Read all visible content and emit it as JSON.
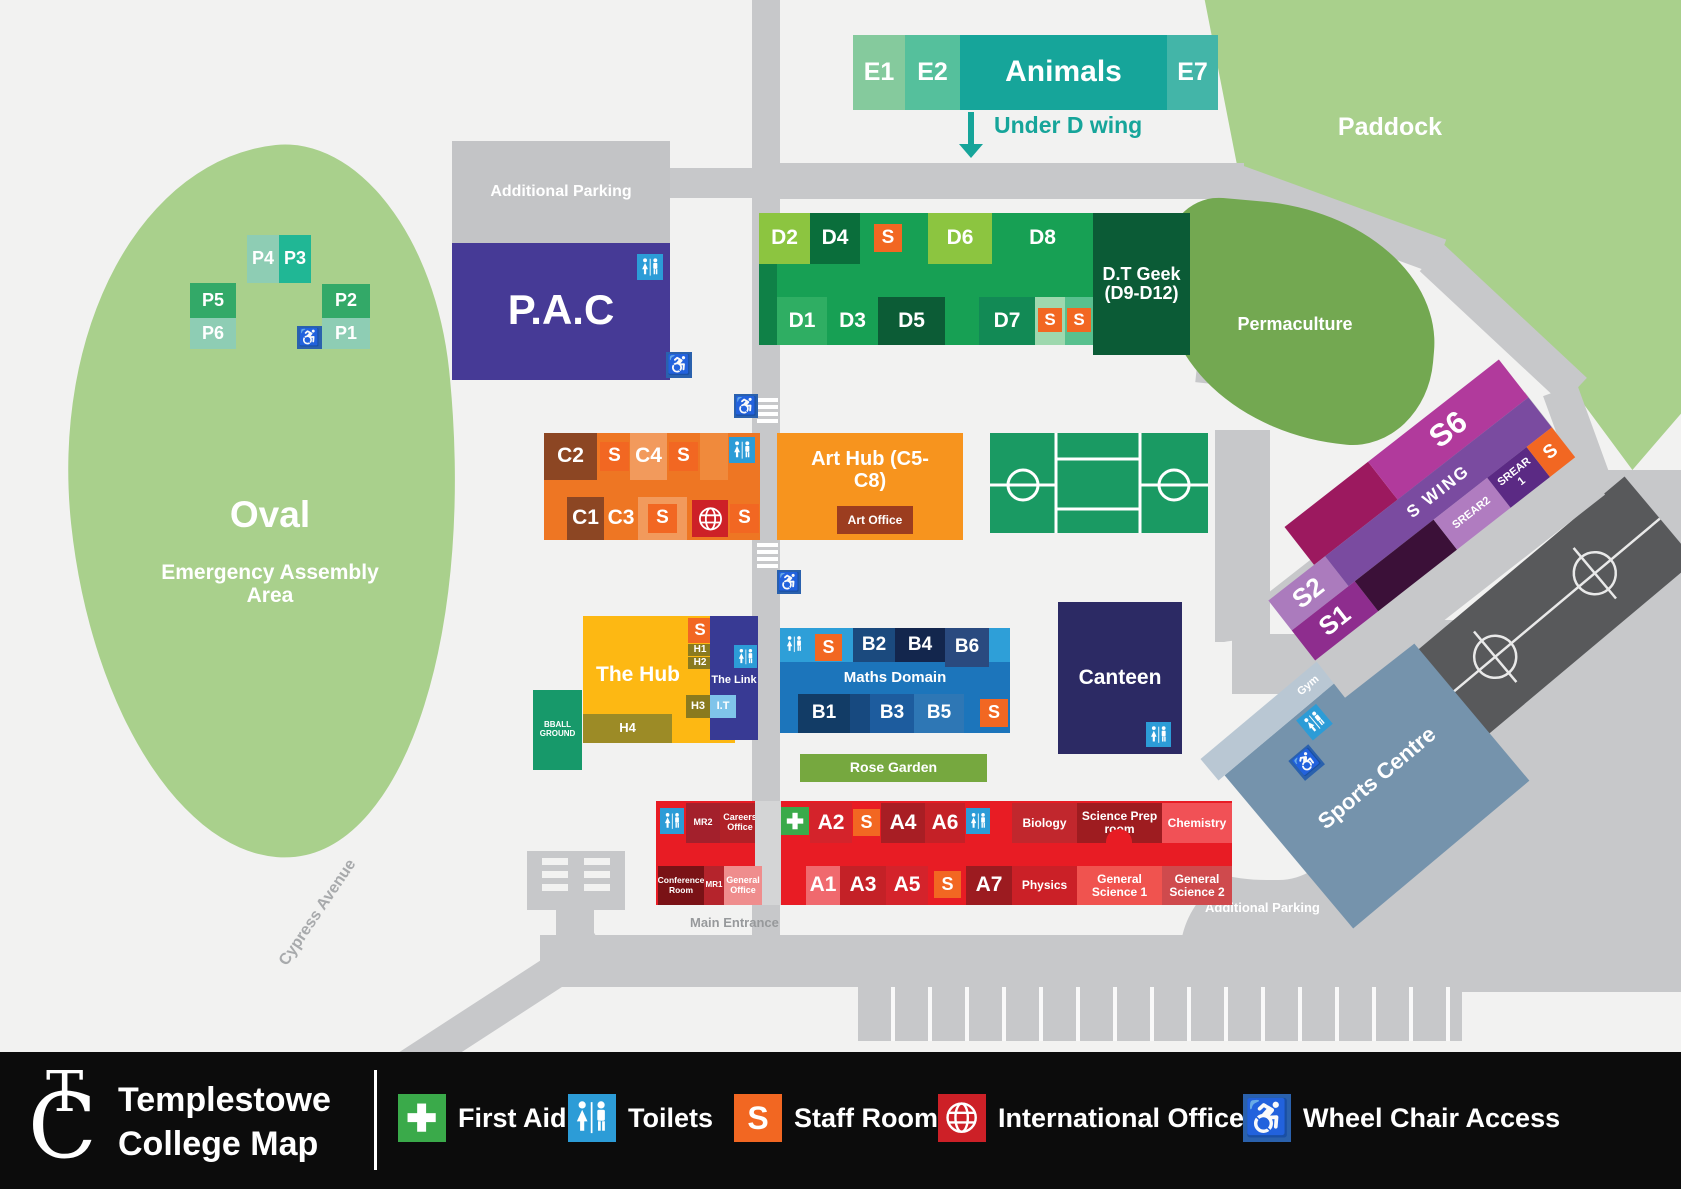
{
  "labels": {
    "s": "S"
  },
  "logo": {
    "t": "T",
    "c": "C"
  },
  "areas": {
    "oval": "Oval",
    "assembly": "Emergency Assembly Area",
    "paddock": "Paddock",
    "permaculture": "Permaculture",
    "rose_garden": "Rose Garden",
    "bball_ground": "BBALL GROUND",
    "main_entrance": "Main Entrance",
    "cypress_avenue": "Cypress Avenue",
    "additional_parking": "Additional Parking"
  },
  "e_wing": {
    "e1": "E1",
    "e2": "E2",
    "animals": "Animals",
    "e7": "E7",
    "under_d_wing": "Under D wing"
  },
  "d_wing": {
    "d1": "D1",
    "d2": "D2",
    "d3": "D3",
    "d4": "D4",
    "d5": "D5",
    "d6": "D6",
    "d7": "D7",
    "d8": "D8",
    "dt_geek": "D.T Geek (D9-D12)"
  },
  "p_blocks": {
    "p1": "P1",
    "p2": "P2",
    "p3": "P3",
    "p4": "P4",
    "p5": "P5",
    "p6": "P6"
  },
  "pac": {
    "name": "P.A.C"
  },
  "c_wing": {
    "c1": "C1",
    "c2": "C2",
    "c3": "C3",
    "c4": "C4",
    "art_hub": "Art Hub (C5-C8)",
    "art_office": "Art Office"
  },
  "b_wing": {
    "name": "Maths Domain",
    "b1": "B1",
    "b2": "B2",
    "b3": "B3",
    "b4": "B4",
    "b5": "B5",
    "b6": "B6"
  },
  "hub": {
    "name": "The Hub",
    "the_link": "The Link",
    "h1": "H1",
    "h2": "H2",
    "h3": "H3",
    "h4": "H4",
    "it": "I.T"
  },
  "canteen": {
    "name": "Canteen"
  },
  "a_wing": {
    "a1": "A1",
    "a2": "A2",
    "a3": "A3",
    "a4": "A4",
    "a5": "A5",
    "a6": "A6",
    "a7": "A7",
    "mr1": "MR1",
    "mr2": "MR2",
    "careers_office": "Careers Office",
    "conference_room": "Conference Room",
    "general_office": "General Office",
    "biology": "Biology",
    "science_prep": "Science Prep room",
    "chemistry": "Chemistry",
    "physics": "Physics",
    "general_science_1": "General Science 1",
    "general_science_2": "General Science 2"
  },
  "s_wing": {
    "name": "S WING",
    "s1": "S1",
    "s2": "S2",
    "s6": "S6",
    "srear1": "SREAR 1",
    "srear2": "SREAR2"
  },
  "sports": {
    "name": "Sports Centre",
    "gym": "Gym"
  },
  "legend": {
    "title_line1": "Templestowe",
    "title_line2": "College Map",
    "first_aid": "First Aid",
    "toilets": "Toilets",
    "staff_room": "Staff Room",
    "international_office": "International Office",
    "wheelchair": "Wheel Chair Access"
  },
  "colors": {
    "staff": "#f26722",
    "toilets": "#2c9cd7",
    "first_aid": "#3aaa4a",
    "international": "#cd2027",
    "wheelchair_access": "#2a61ad"
  }
}
